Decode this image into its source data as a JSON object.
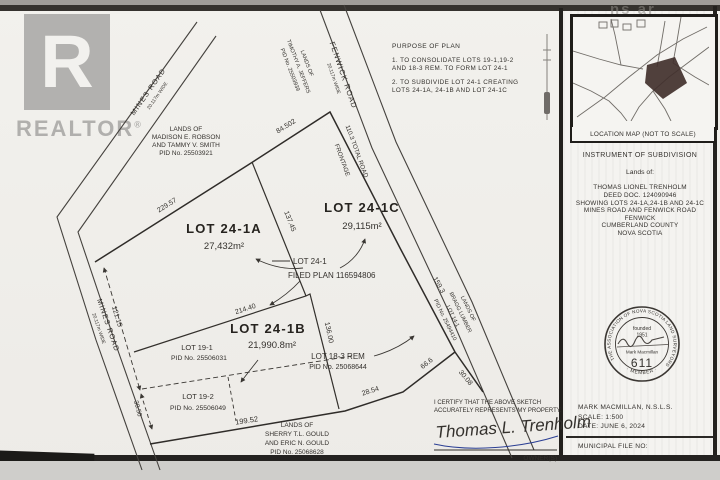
{
  "logo": {
    "r": "R",
    "realtor": "REALTOR",
    "reg": "®"
  },
  "watermark": {
    "nsar": "ns ar"
  },
  "purpose": {
    "title": "PURPOSE OF PLAN",
    "line1a": "1. TO CONSOLIDATE LOTS 19-1,19-2",
    "line1b": "AND 18-3 REM. TO FORM LOT 24-1",
    "line2a": "2. TO SUBDIVIDE LOT 24-1 CREATING",
    "line2b": "LOTS 24-1A, 24-1B AND LOT 24-1C"
  },
  "roads": {
    "mines_top_name": "MINES ROAD",
    "mines_top_width": "20.117m WIDE",
    "mines_left_name": "MINES ROAD",
    "mines_left_width": "20.117m WIDE",
    "fenwick_name": "FENWICK ROAD",
    "fenwick_width": "20.117m WIDE"
  },
  "adjacent": {
    "jeffers": {
      "l1": "LANDS OF",
      "l2": "TIMOTHY A. JEFFERS",
      "l3": "PID No. 25503939"
    },
    "robson": {
      "l1": "LANDS OF",
      "l2": "MADISON E. ROBSON",
      "l3": "AND TAMMY V. SMITH",
      "l4": "PID No. 25503921"
    },
    "gould": {
      "l1": "LANDS OF",
      "l2": "SHERRY T.L. GOULD",
      "l3": "AND ERIC N. GOULD",
      "l4": "PID No. 25068628"
    },
    "bragg": {
      "l1": "LANDS OF",
      "l2": "BRAGG LUMBER",
      "l3": "LOT 14-1",
      "l4": "PID No. 25494410"
    }
  },
  "lots": {
    "lot24_1a": {
      "name": "LOT 24-1A",
      "area": "27,432m²"
    },
    "lot24_1b": {
      "name": "LOT 24-1B",
      "area": "21,990.8m²"
    },
    "lot24_1c": {
      "name": "LOT 24-1C",
      "area": "29,115m²"
    },
    "lot24_1": {
      "name": "LOT 24-1",
      "plan": "FILED PLAN 116594806"
    },
    "lot19_1": {
      "name": "LOT 19-1",
      "pid": "PID No. 25506031"
    },
    "lot19_2": {
      "name": "LOT 19-2",
      "pid": "PID No. 25506049"
    },
    "lot18_3": {
      "name": "LOT 18-3 REM",
      "pid": "PID No. 25068644"
    }
  },
  "dims": {
    "d229": "229.57",
    "d84": "84.502",
    "d110a": "110.3 TOTAL ROAD",
    "d110b": "FRONTAGE",
    "d137": "137.45",
    "d159": "159.3",
    "d214": "214.40",
    "d136": "136.00",
    "d121": "121.15",
    "d3050": "30.50",
    "d199": "199.52",
    "d2854": "28.54",
    "d666": "66.6",
    "d3008": "30.08"
  },
  "certificate": {
    "l1": "I CERTIFY THAT THE ABOVE SKETCH",
    "l2": "ACCURATELY REPRESENTS MY PROPERTY.",
    "signature": "Thomas L. Trenholm",
    "owner_label": "OWNER(S)"
  },
  "location_map": {
    "label": "LOCATION MAP  (NOT TO SCALE)"
  },
  "title_block": {
    "heading": "INSTRUMENT OF SUBDIVISION",
    "lands_of": "Lands of:",
    "owner": "THOMAS LIONEL TRENHOLM",
    "deed": "DEED DOC. 124090946",
    "showing": "SHOWING LOTS 24-1A,24-1B AND 24-1C",
    "roads": "MINES ROAD AND FENWICK ROAD",
    "community": "FENWICK",
    "county": "CUMBERLAND COUNTY",
    "province": "NOVA SCOTIA"
  },
  "seal": {
    "ring_top": "THE ASSOCIATION OF NOVA SCOTIA LAND SURVEYORS",
    "ring_bottom": "· MEMBER ·",
    "founded1": "founded",
    "founded2": "1951",
    "name": "Mark Macmillan",
    "number": "611"
  },
  "footer": {
    "surveyor": "MARK MACMILLAN, N.S.L.S.",
    "scale": "SCALE:  1:500",
    "date": "DATE:  JUNE 6, 2024",
    "municipal": "MUNICIPAL FILE NO:"
  },
  "colors": {
    "ink": "#34312d",
    "blue_ink": "#2b3f94",
    "paper": "#f2f1ed"
  }
}
